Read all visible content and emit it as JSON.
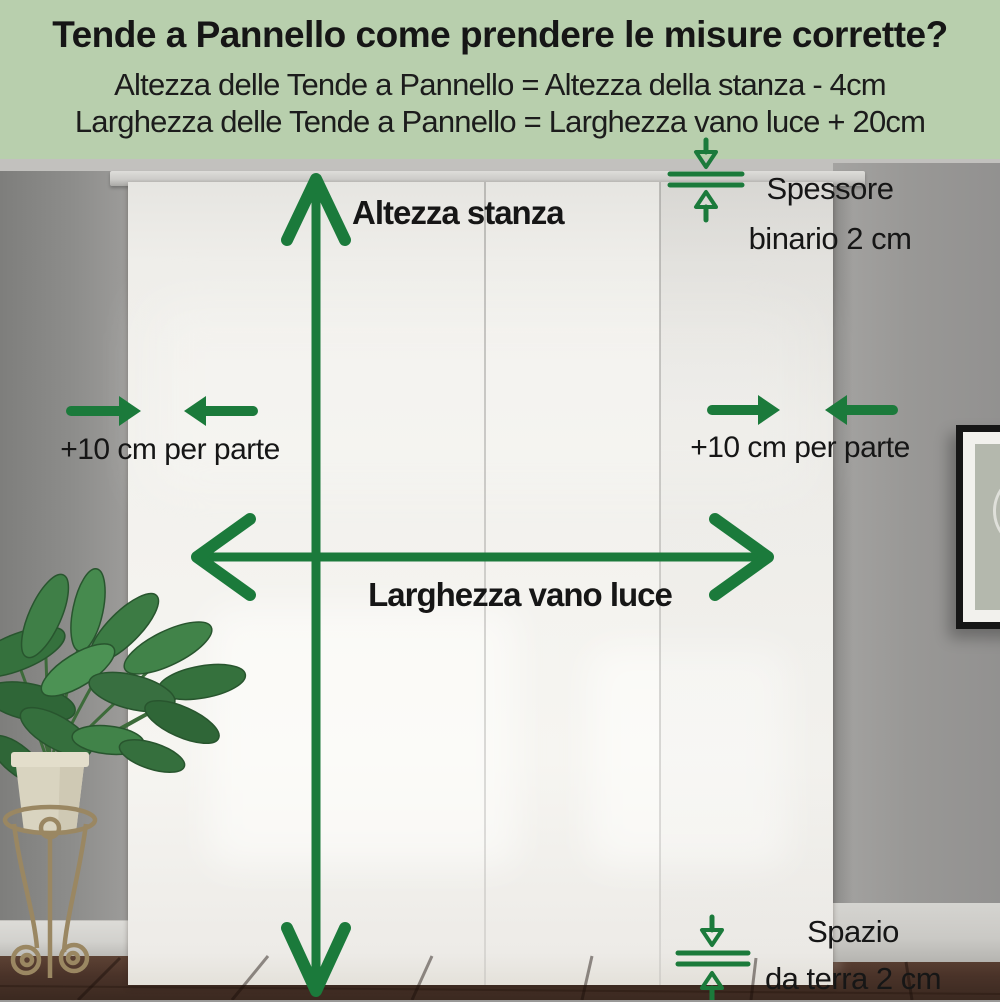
{
  "header": {
    "title": "Tende a Pannello come prendere le misure corrette?",
    "formula_height": "Altezza delle Tende a Pannello = Altezza della stanza - 4cm",
    "formula_width": "Larghezza delle Tende a Pannello = Larghezza vano luce + 20cm"
  },
  "annotations": {
    "room_height_label": "Altezza stanza",
    "opening_width_label": "Larghezza vano luce",
    "left_allowance_label": "+10 cm per parte",
    "right_allowance_label": "+10 cm per parte",
    "rail_thickness_line1": "Spessore",
    "rail_thickness_line2": "binario 2 cm",
    "floor_gap_line1": "Spazio",
    "floor_gap_line2": "da terra 2 cm"
  },
  "icons": {
    "room_height": "vertical-double-arrow",
    "opening_width": "horizontal-double-arrow",
    "left_allowance": "opposing-horizontal-arrows",
    "right_allowance": "opposing-horizontal-arrows",
    "rail_thickness": "thickness-gauge",
    "floor_gap": "thickness-gauge"
  },
  "colors": {
    "accent_green": "#1b7a3b",
    "header_background": "#b8cfad",
    "text_dark": "#161616"
  }
}
